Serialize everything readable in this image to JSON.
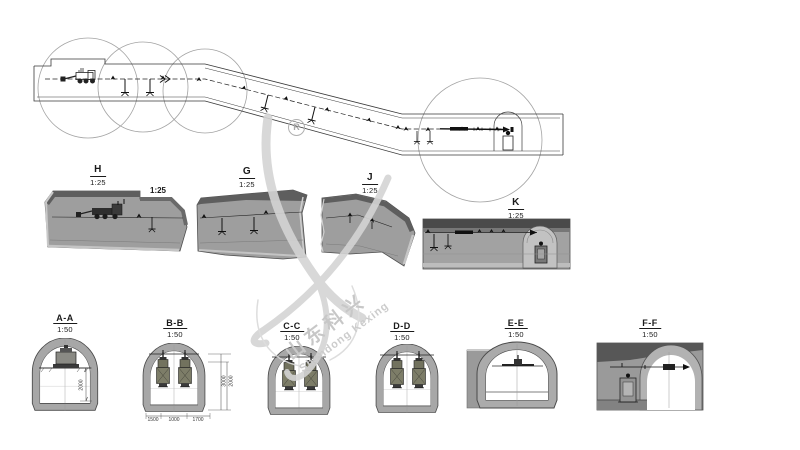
{
  "watermark": {
    "cn": "山东科兴",
    "en": "Shandong Kexing",
    "registered": "R",
    "color": "#c7c7c7"
  },
  "plan": {
    "extra_scale": "1:25"
  },
  "details": [
    {
      "name": "H",
      "scale": "1:25"
    },
    {
      "name": "G",
      "scale": "1:25"
    },
    {
      "name": "J",
      "scale": "1:25"
    },
    {
      "name": "K",
      "scale": "1:25"
    }
  ],
  "cross_sections": [
    {
      "name": "A-A",
      "scale": "1:50"
    },
    {
      "name": "B-B",
      "scale": "1:50"
    },
    {
      "name": "C-C",
      "scale": "1:50"
    },
    {
      "name": "D-D",
      "scale": "1:50"
    },
    {
      "name": "E-E",
      "scale": "1:50"
    },
    {
      "name": "F-F",
      "scale": "1:50"
    }
  ],
  "dimensions": {
    "aa_vertical": "2000",
    "bb_vertical": [
      "3000",
      "2000"
    ],
    "bb_horizontal": [
      "1500",
      "1000",
      "1700"
    ]
  }
}
